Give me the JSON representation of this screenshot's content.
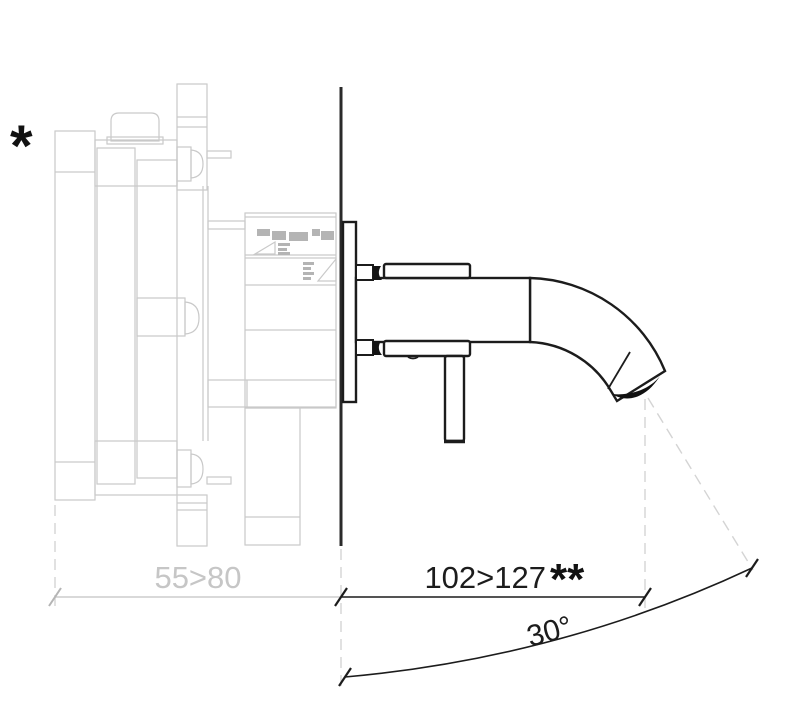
{
  "drawing": {
    "type": "technical-dimension-drawing",
    "subject": "wall-mounted-single-lever-basin-mixer-side-view",
    "annotations": {
      "footnote_star": "*",
      "double_star": "**",
      "recess_depth_label": "55>80",
      "spout_projection_label": "102>127",
      "spout_angle_label": "30°"
    },
    "colors": {
      "background": "#ffffff",
      "concealed_body_gray": "#c9c9c9",
      "detail_fill_gray": "#b4b4b4",
      "dashed_reference_gray": "#d4d4d4",
      "dimension_text_gray": "#c6c6c6",
      "fixture_black": "#1c1c1c"
    }
  }
}
